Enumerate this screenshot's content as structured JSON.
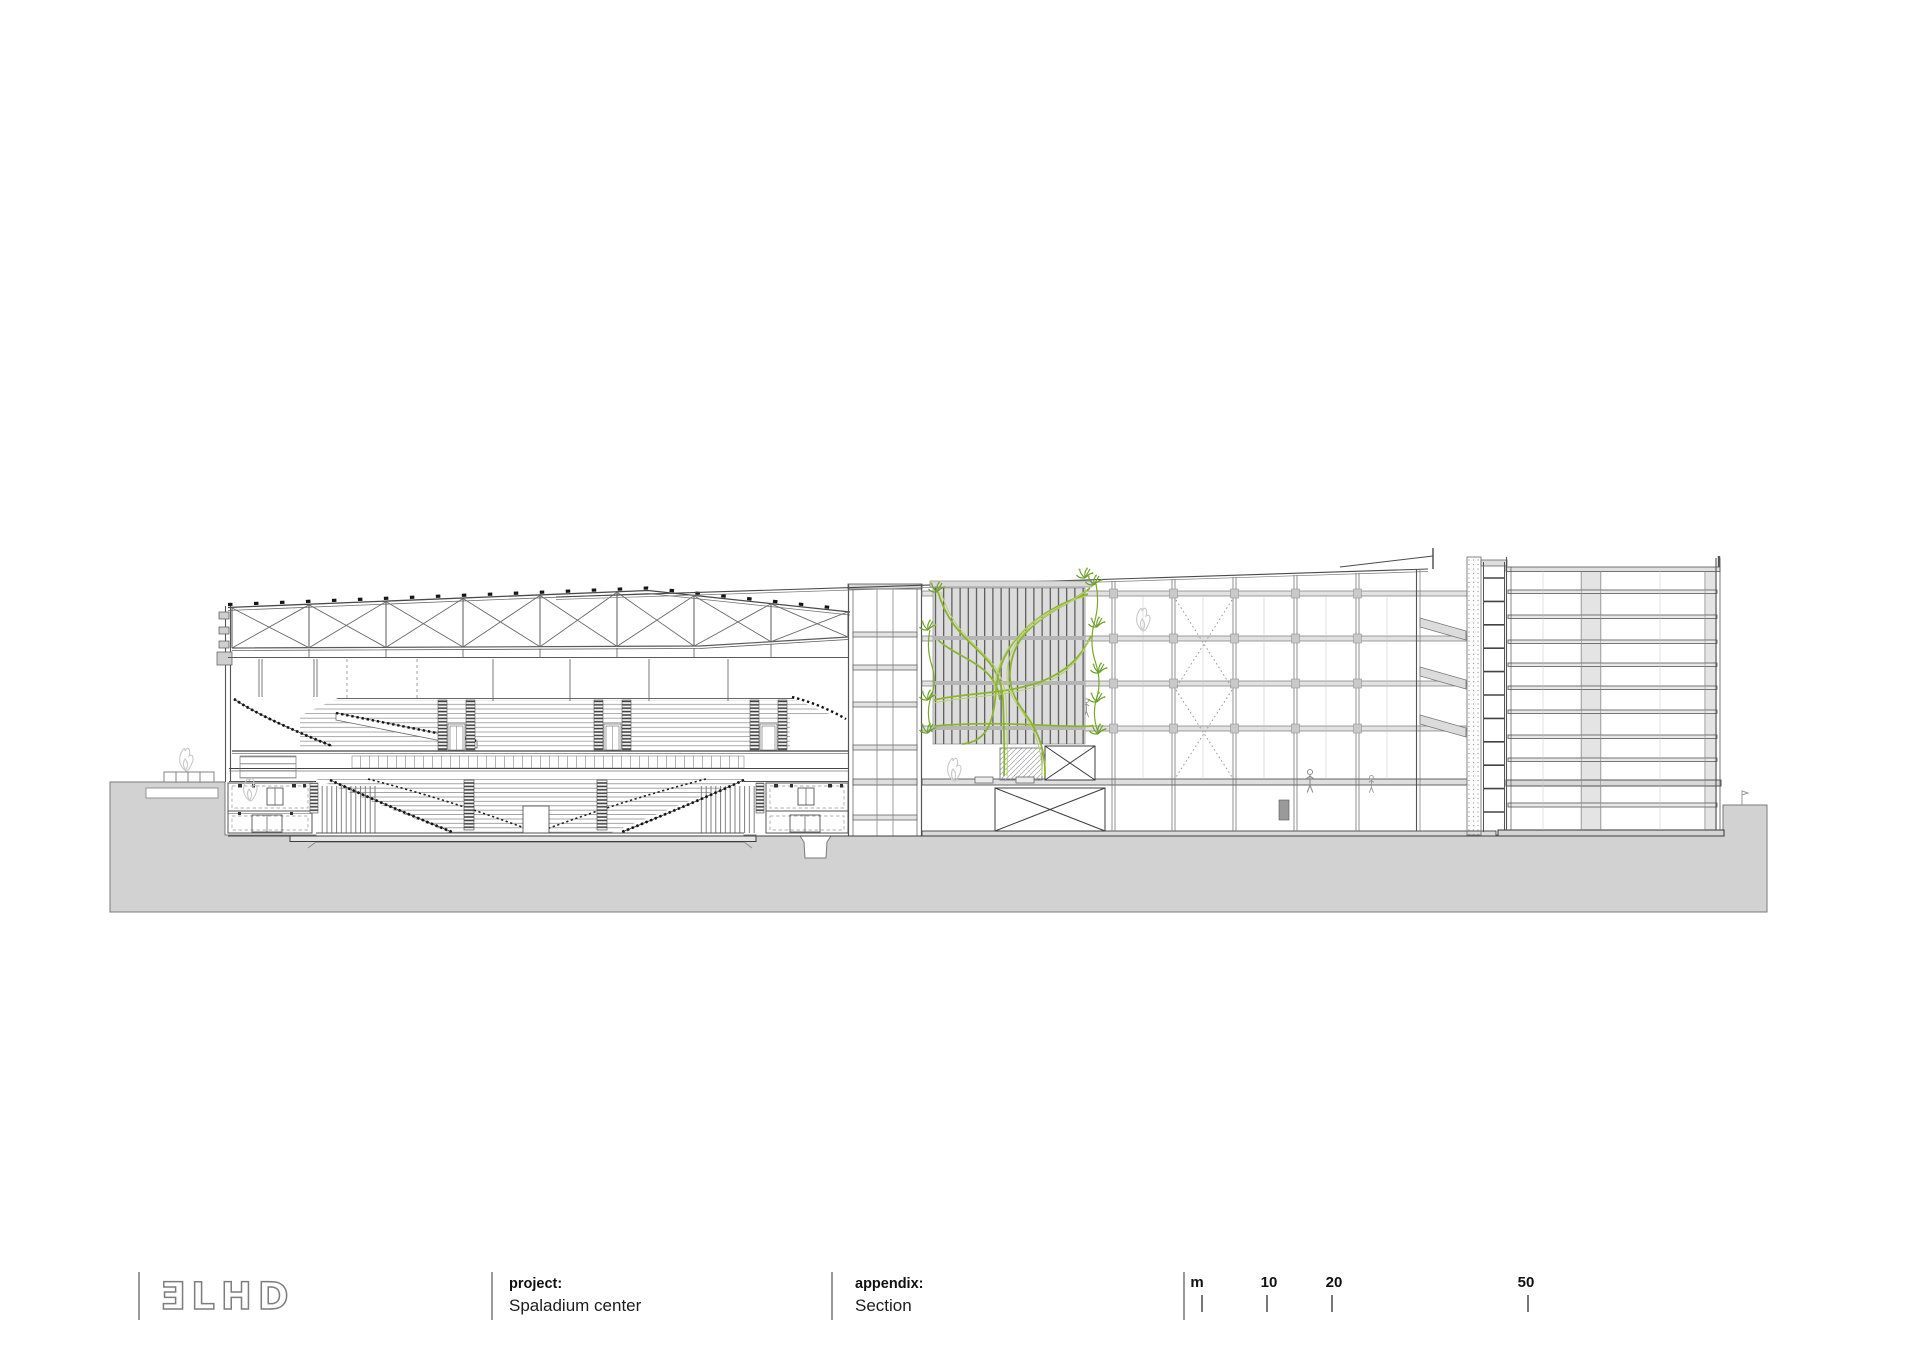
{
  "title_block": {
    "logo_text": "ƎLHD",
    "fields": [
      {
        "label": "project:",
        "value": "Spaladium center"
      },
      {
        "label": "appendix:",
        "value": "Section"
      }
    ],
    "scale_bar": {
      "unit": "m",
      "mark_10": "10",
      "mark_20": "20",
      "mark_50": "50"
    }
  },
  "drawing": {
    "subject": "Spaladium center cross section",
    "colors": {
      "ground": "#d2d2d2",
      "line": "#4a4a4a",
      "panel": "#dcdcdc",
      "slab": "#e3e3e3",
      "vine": "#8cb431",
      "vine_light": "#b9d06e",
      "plant": "#6da02b"
    }
  }
}
